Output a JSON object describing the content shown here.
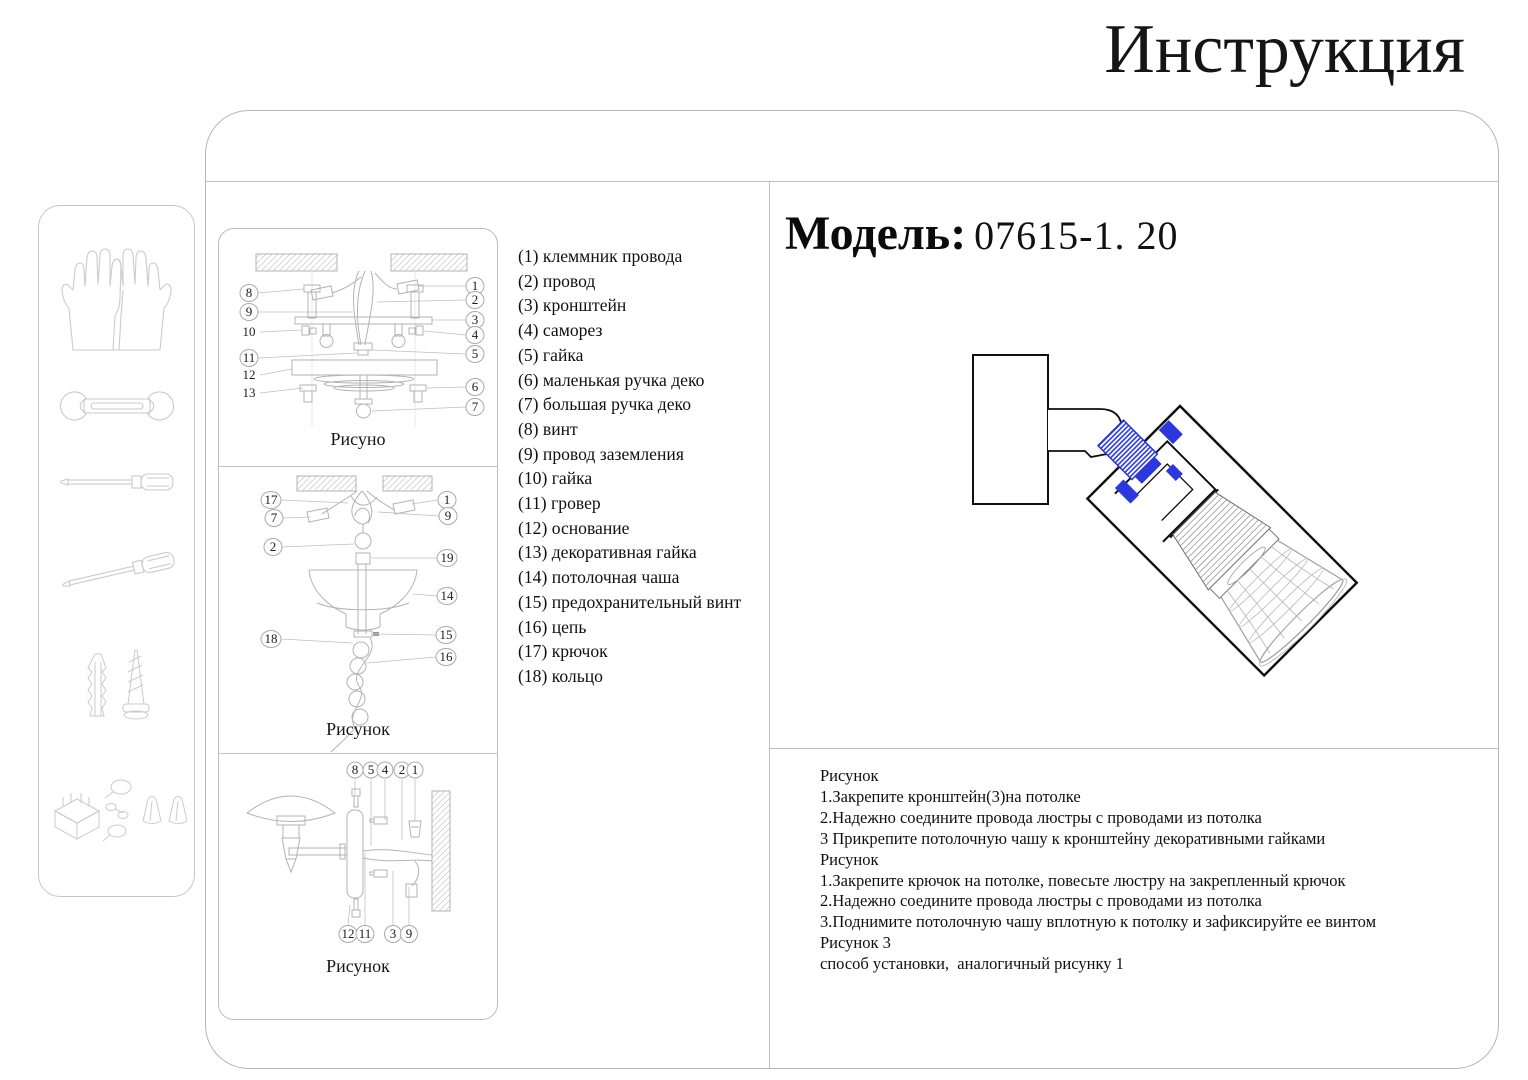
{
  "title": "Инструкция",
  "model": {
    "label": "Модель:",
    "value": "07615-1. 20"
  },
  "parts": [
    "(1) клеммник провода",
    "(2) провод",
    "(3) кронштейн",
    "(4) саморез",
    "(5) гайка",
    "(6) маленькая ручка деко",
    "(7) большая ручка деко",
    "(8) винт",
    "(9) провод заземления",
    "(10) гайка",
    "(11) гровер",
    "(12) основание",
    "(13) декоративная гайка",
    "(14) потолочная чаша",
    "(15) предохранительный винт",
    "(16) цепь",
    "(17) крючок",
    "(18) кольцо"
  ],
  "figures": {
    "fig1": {
      "caption": "Рисуно",
      "left": [
        "8",
        "9",
        "10",
        "11",
        "12",
        "13"
      ],
      "right": [
        "1",
        "2",
        "3",
        "4",
        "5",
        "6",
        "7"
      ]
    },
    "fig2": {
      "caption": "Рисунок",
      "left": [
        "17",
        "7",
        "2",
        "18"
      ],
      "right": [
        "1",
        "9",
        "19",
        "14",
        "15",
        "16"
      ]
    },
    "fig3": {
      "caption": "Рисунок",
      "top": [
        "8",
        "5",
        "4",
        "2",
        "1"
      ],
      "bottom": [
        "12",
        "11",
        "3",
        "9"
      ]
    }
  },
  "instructions": {
    "lines": [
      "Рисунок",
      "1.Закрепите кронштейн(3)на потолке",
      "2.Надежно соедините провода люстры с проводами из потолка",
      "3 Прикрепите потолочную чашу к кронштейну декоративными гайками",
      "Рисунок",
      "1.Закрепите крючок на потолке, повесьте люстру на закрепленный крючок",
      "2.Надежно соедините провода люстры с проводами из потолка",
      "3.Поднимите потолочную чашу вплотную к потолку и зафиксируйте ее винтом",
      "Рисунок 3",
      "способ установки,  аналогичный рисунку 1"
    ]
  },
  "sidebar": {
    "tools": [
      "gloves",
      "wrench",
      "flat-screwdriver",
      "second-screwdriver",
      "anchor-and-screw",
      "fasteners"
    ]
  },
  "colors": {
    "accent_blue": "#2a38dd",
    "line_gray": "#b3b3b3"
  }
}
